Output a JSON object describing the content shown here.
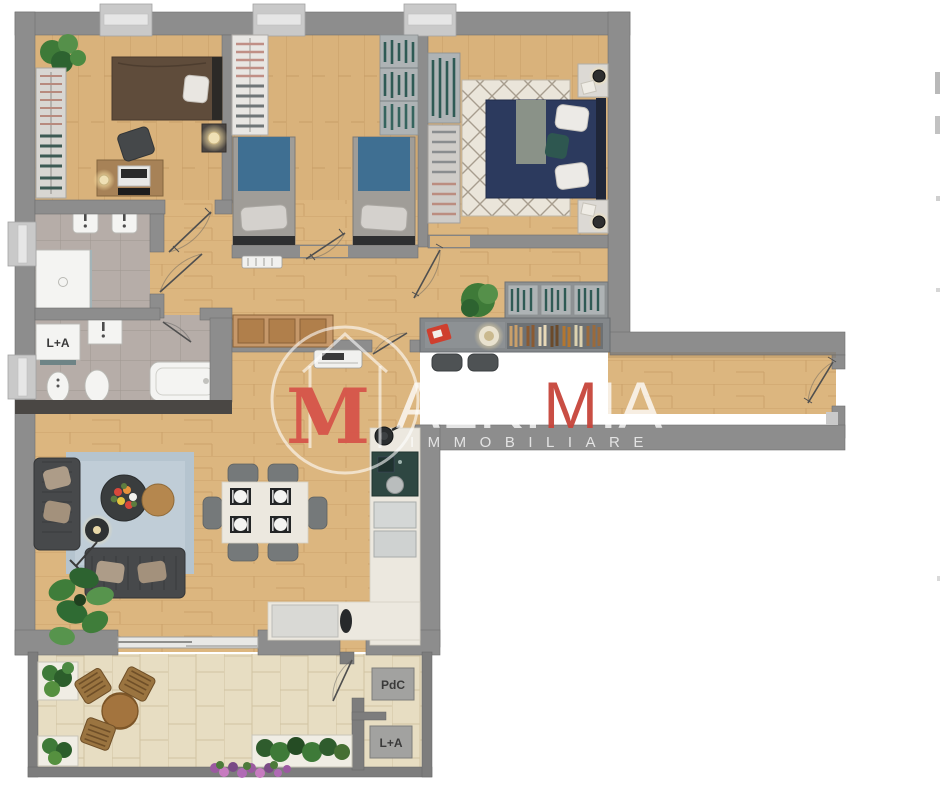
{
  "watermark": {
    "monogram": "M",
    "brand_pre": "ALKI",
    "brand_accent_letter": "M",
    "brand_post": "IA",
    "tagline": "IMMOBILIARE",
    "accent_color": "#c7453b",
    "monogram_color": "#d6554a"
  },
  "labels": {
    "laundry_unit": "L+A",
    "terrace_heat_pump": "PdC",
    "terrace_laundry": "L+A"
  },
  "palette": {
    "wall_gray": "#8d8d8d",
    "wood_floor": "#d9b27b",
    "bathroom_tile": "#b6ada8",
    "terrace_stone": "#e7ddc2",
    "kitchen_marble": "#ece8df",
    "master_bed_navy": "#2c3a5e",
    "sofa_charcoal": "#47494b",
    "accent_blue_runner": "#3f6f92",
    "living_rug_blue": "#b5c4cf"
  }
}
